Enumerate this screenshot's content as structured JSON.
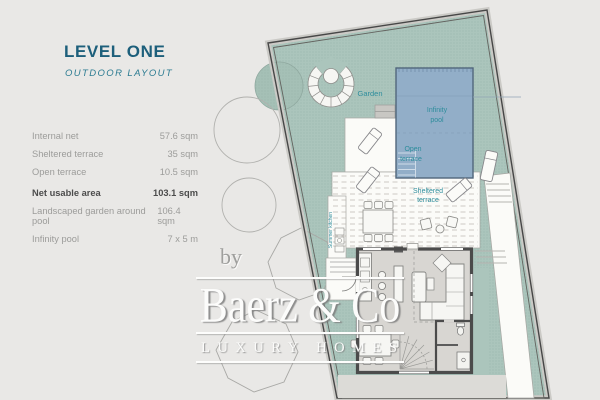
{
  "colors": {
    "background": "#e9e8e6",
    "title_teal": "#1d5f7b",
    "plan_label_teal": "#2e8d9c",
    "plot_green": "#abc5bc",
    "pool_blue": "#92aec8",
    "wall_gray": "#4b4b4b",
    "watermark_white": "#fcfcfb"
  },
  "panel": {
    "title": "LEVEL ONE",
    "subtitle": "OUTDOOR LAYOUT",
    "measurements": [
      {
        "label": "Internal net",
        "value": "57.6 sqm"
      },
      {
        "label": "Sheltered terrace",
        "value": "35 sqm"
      },
      {
        "label": "Open terrace",
        "value": "10.5 sqm"
      },
      {
        "label": "Net usable area",
        "value": "103.1 sqm"
      }
    ],
    "measurements_secondary": [
      {
        "label": "Landscaped garden around pool",
        "value": "106.4 sqm"
      },
      {
        "label": "Infinity pool",
        "value": "7 x 5 m"
      }
    ]
  },
  "plan": {
    "labels": {
      "garden": "Garden",
      "infinity_pool_line1": "Infinity",
      "infinity_pool_line2": "pool",
      "open_terrace_line1": "Open",
      "open_terrace_line2": "terrace",
      "sheltered_terrace_line1": "Sheltered",
      "sheltered_terrace_line2": "terrace",
      "summer_kitchen": "Summer kitchen"
    }
  },
  "watermark": {
    "prefix": "by",
    "brand": "Baerz & Co",
    "tagline": "LUXURY HOMES"
  }
}
